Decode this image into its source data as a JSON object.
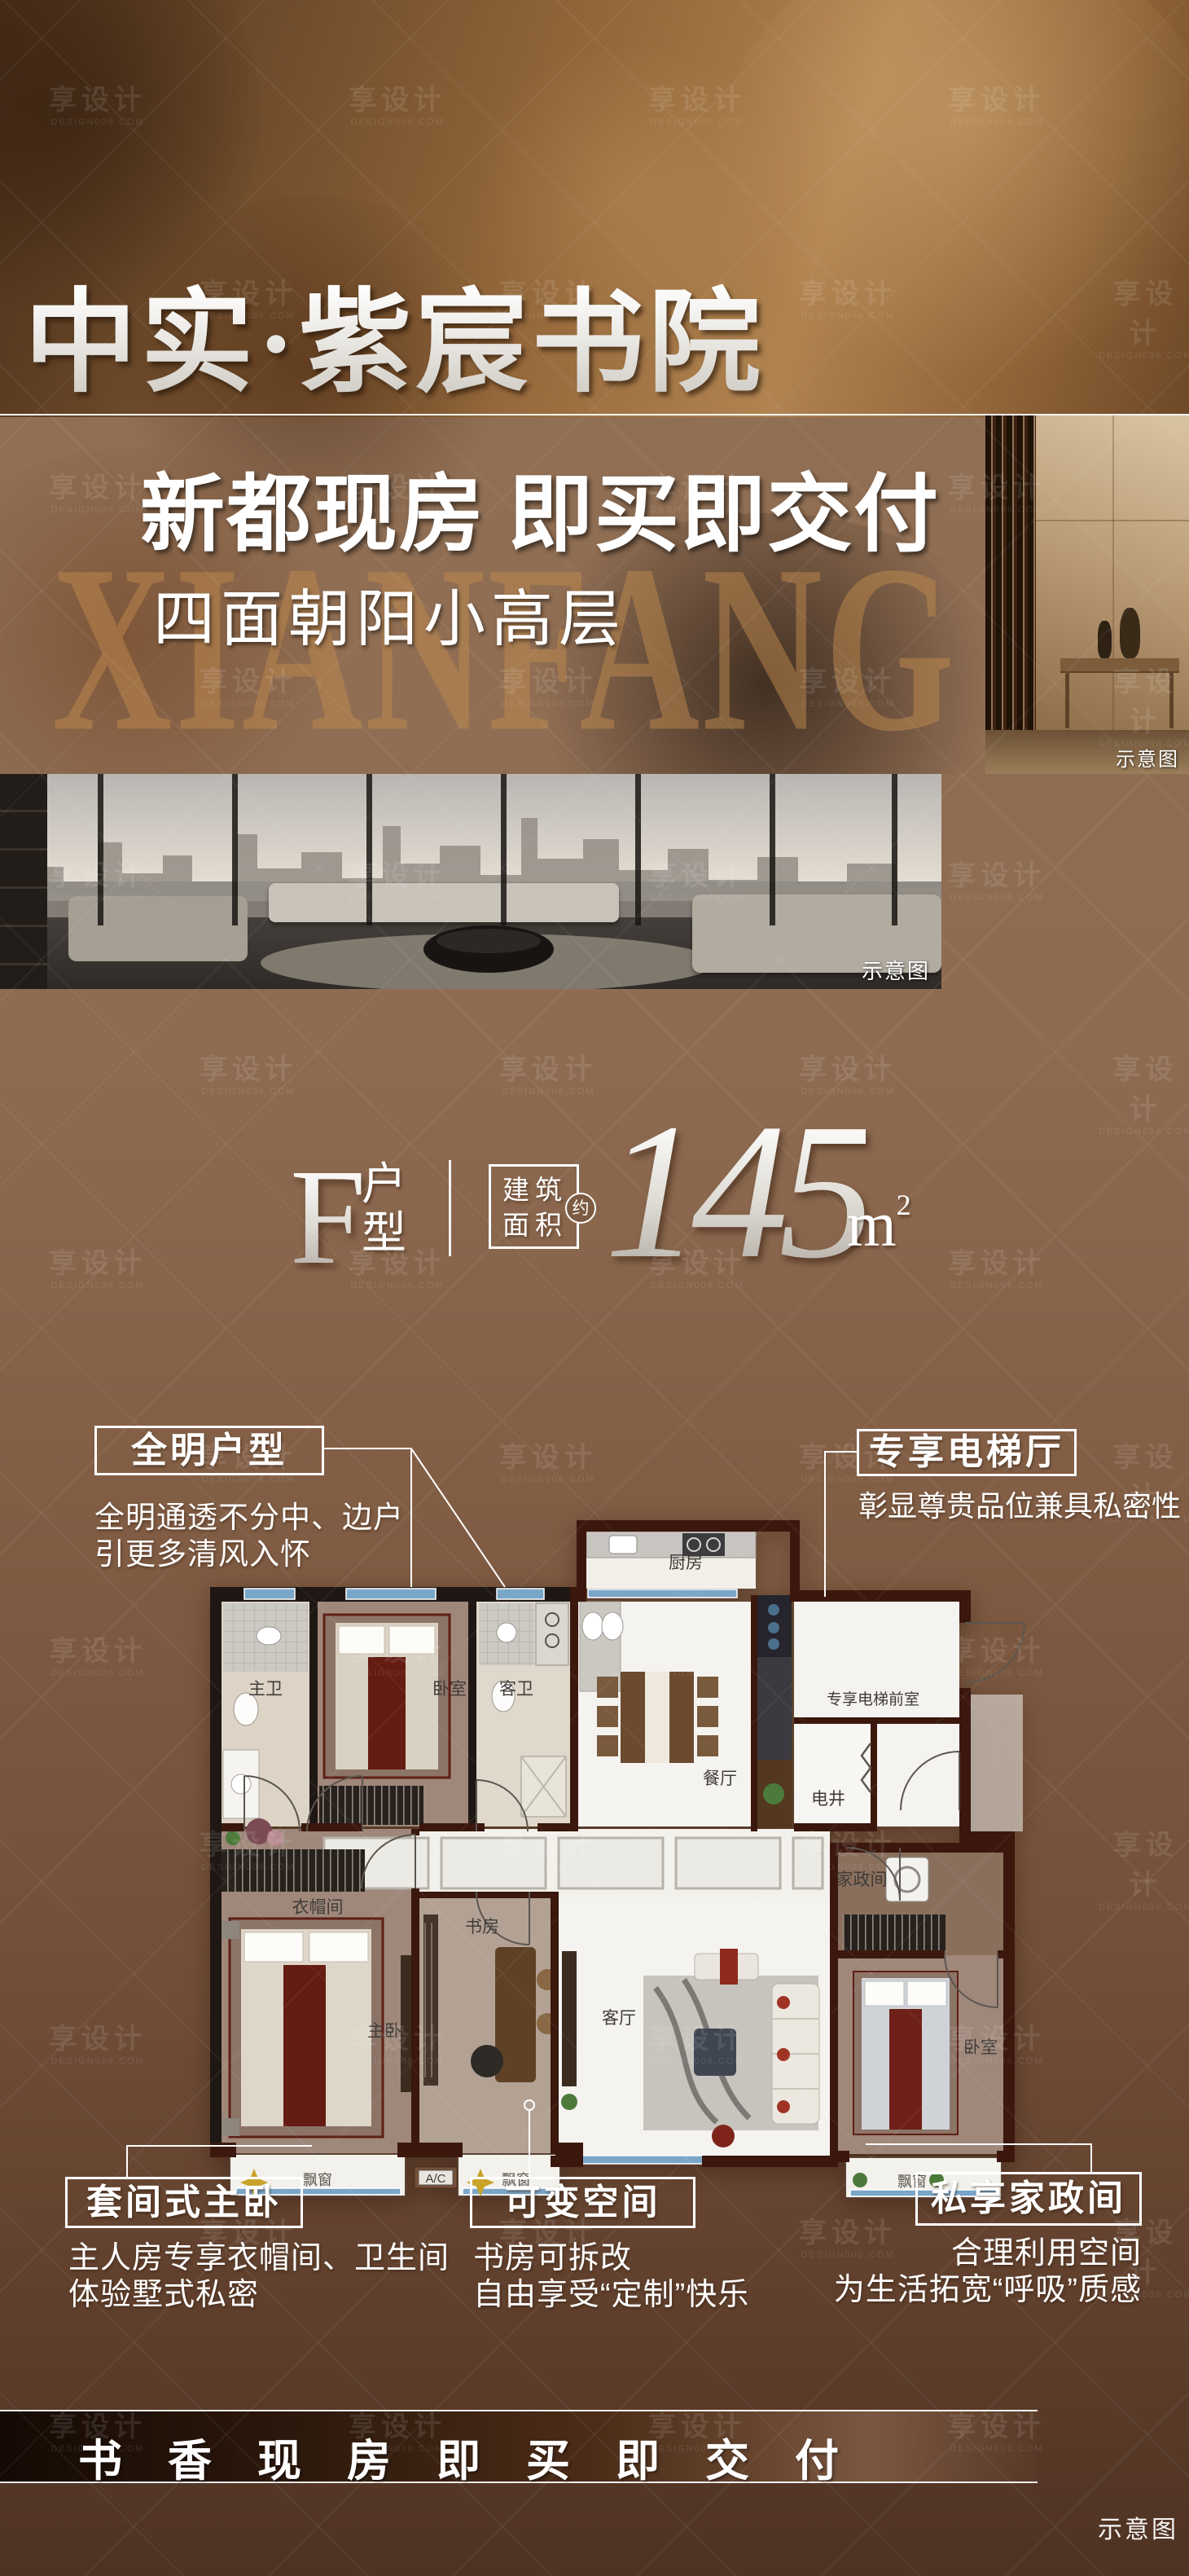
{
  "palette": {
    "bronze": "#b08350",
    "banner_dark": "#3a1d0d",
    "body_brown": "#7d5a42",
    "accent_gold": "#c08a4e",
    "text_white": "#ffffff",
    "wall_maroon": "#3b170d",
    "window_blue": "#7aa6c8",
    "bed_red": "#661c11"
  },
  "watermark": {
    "brand": "享设计",
    "domain": "DESIGN006.COM"
  },
  "header": {
    "title": "中实·紫宸书院"
  },
  "banner": {
    "headline": "新都现房 即买即交付",
    "subline": "四面朝阳小高层",
    "bg_word": "XIANFANG",
    "photo_tag": "示意图"
  },
  "gallery": {
    "photo_tag": "示意图"
  },
  "unit": {
    "letter": "F",
    "suffix_top": "户",
    "suffix_bottom": "型",
    "area_row1": "建筑",
    "area_row2": "面积",
    "approx": "约",
    "value": "145",
    "unit_base": "m",
    "unit_sup": "2"
  },
  "callouts": {
    "allbright": {
      "title": "全明户型",
      "line1": "全明通透不分中、边户",
      "line2": "引更多清风入怀"
    },
    "elevator": {
      "title": "专享电梯厅",
      "line1": "彰显尊贵品位兼具私密性"
    },
    "suite": {
      "title": "套间式主卧",
      "line1": "主人房专享衣帽间、卫生间",
      "line2": "体验墅式私密"
    },
    "flex": {
      "title": "可变空间",
      "line1": "书房可拆改",
      "line2": "自由享受“定制”快乐"
    },
    "housework": {
      "title": "私享家政间",
      "line1": "合理利用空间",
      "line2": "为生活拓宽“呼吸”质感"
    }
  },
  "floorplan": {
    "rooms": {
      "kitchen": "厨房",
      "master_bath": "主卫",
      "bedroom_mid": "卧室",
      "guest_bath": "客卫",
      "dining": "餐厅",
      "elevator_lobby": "专享电梯前室",
      "shaft": "电井",
      "cloakroom": "衣帽间",
      "master_bedroom": "主卧",
      "study": "书房",
      "living": "客厅",
      "laundry": "家政间",
      "bedroom_right": "卧室",
      "bay_master": "飘窗",
      "bay_study": "飘窗",
      "bay_right": "飘窗",
      "ac": "A/C"
    }
  },
  "footer": {
    "slogan": "书香现房即买即交付",
    "tag": "示意图"
  }
}
